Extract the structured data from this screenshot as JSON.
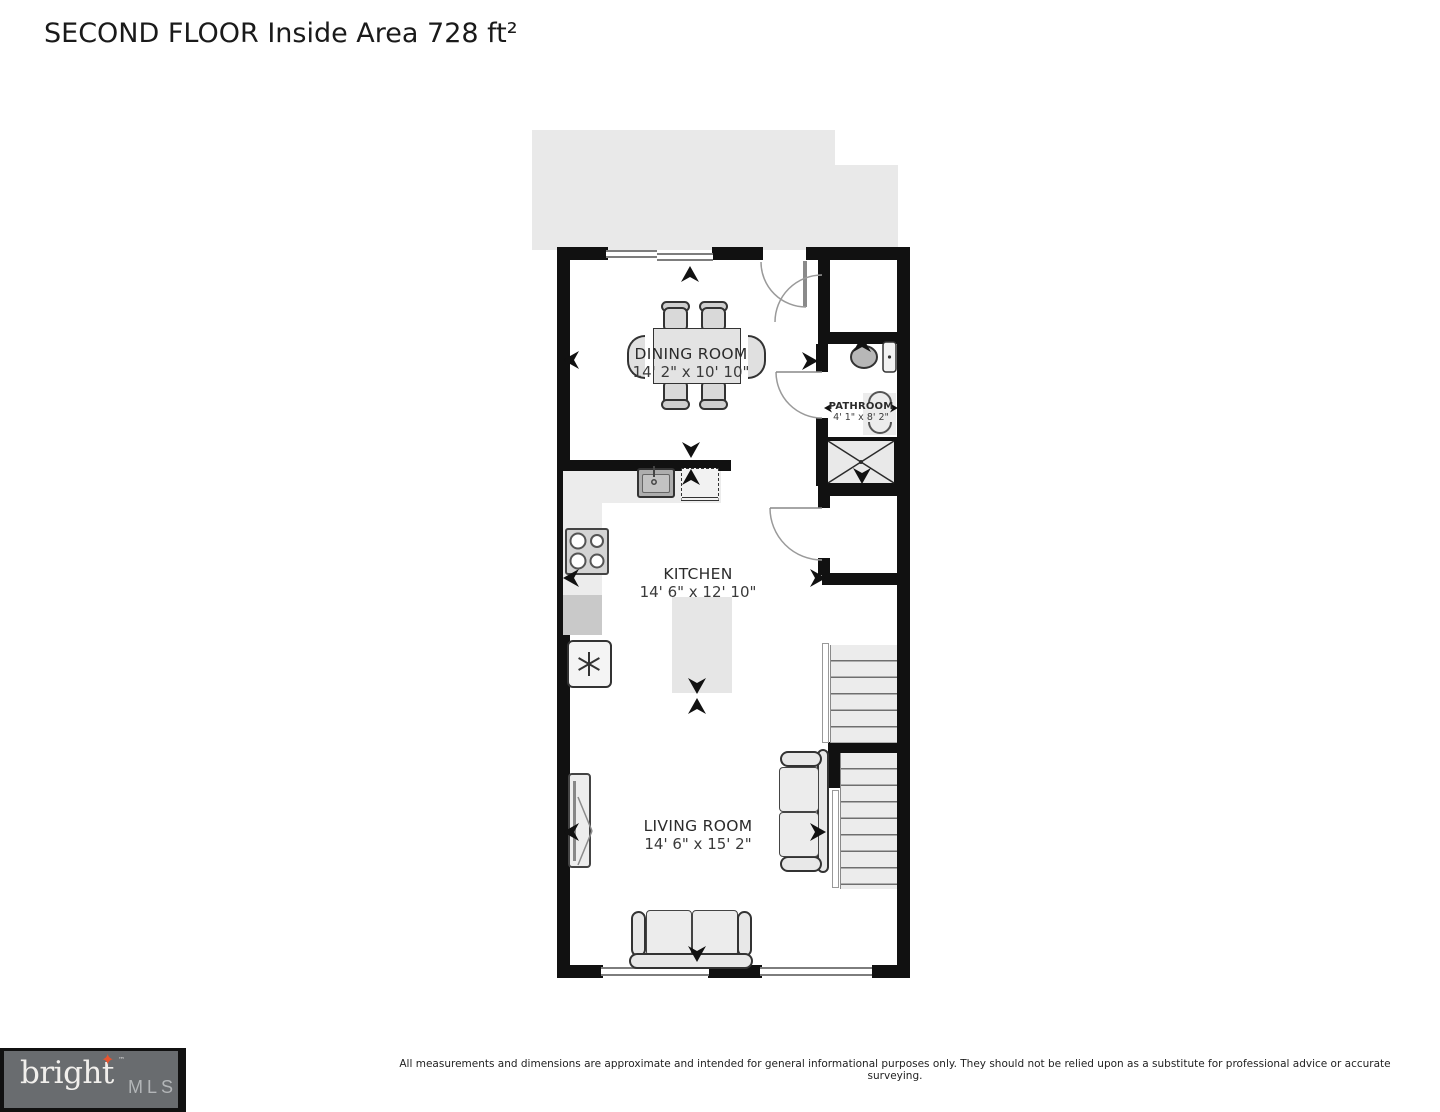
{
  "title": "SECOND FLOOR Inside Area 728 ft²",
  "rooms": [
    {
      "name": "DINING ROOM",
      "dims": "14' 2\" x 10' 10\""
    },
    {
      "name": "KITCHEN",
      "dims": "14' 6\" x 12' 10\""
    },
    {
      "name": "LIVING ROOM",
      "dims": "14' 6\" x 15' 2\""
    },
    {
      "name": "PATHROOM",
      "dims": "4' 1\" x 8' 2\""
    }
  ],
  "footer": {
    "disclaimer": "All measurements and dimensions are approximate and intended for general informational purposes only. They should not be relied upon as a substitute for professional advice or accurate surveying."
  },
  "logo": {
    "brand": "bright",
    "mls": "MLS",
    "tm": "™",
    "star": "✦"
  },
  "colors": {
    "wall": "#111111",
    "exterior_mass": "#e9e9e9",
    "furniture_fill": "#e8e8e8",
    "logo_bg": "#696c6f",
    "logo_star": "#e8542f",
    "logo_brand_text": "#f1efec",
    "logo_mls_text": "#b3b6b8"
  },
  "fixtures": [
    "dining-table",
    "dining-chairs",
    "kitchen-counter",
    "kitchen-sink",
    "dishwasher",
    "stove",
    "refrigerator",
    "kitchen-island",
    "toilet",
    "bathroom-sink",
    "shower",
    "stairs",
    "tv-console",
    "sofa",
    "loveseat",
    "door-swing",
    "window",
    "measure-arrows"
  ]
}
